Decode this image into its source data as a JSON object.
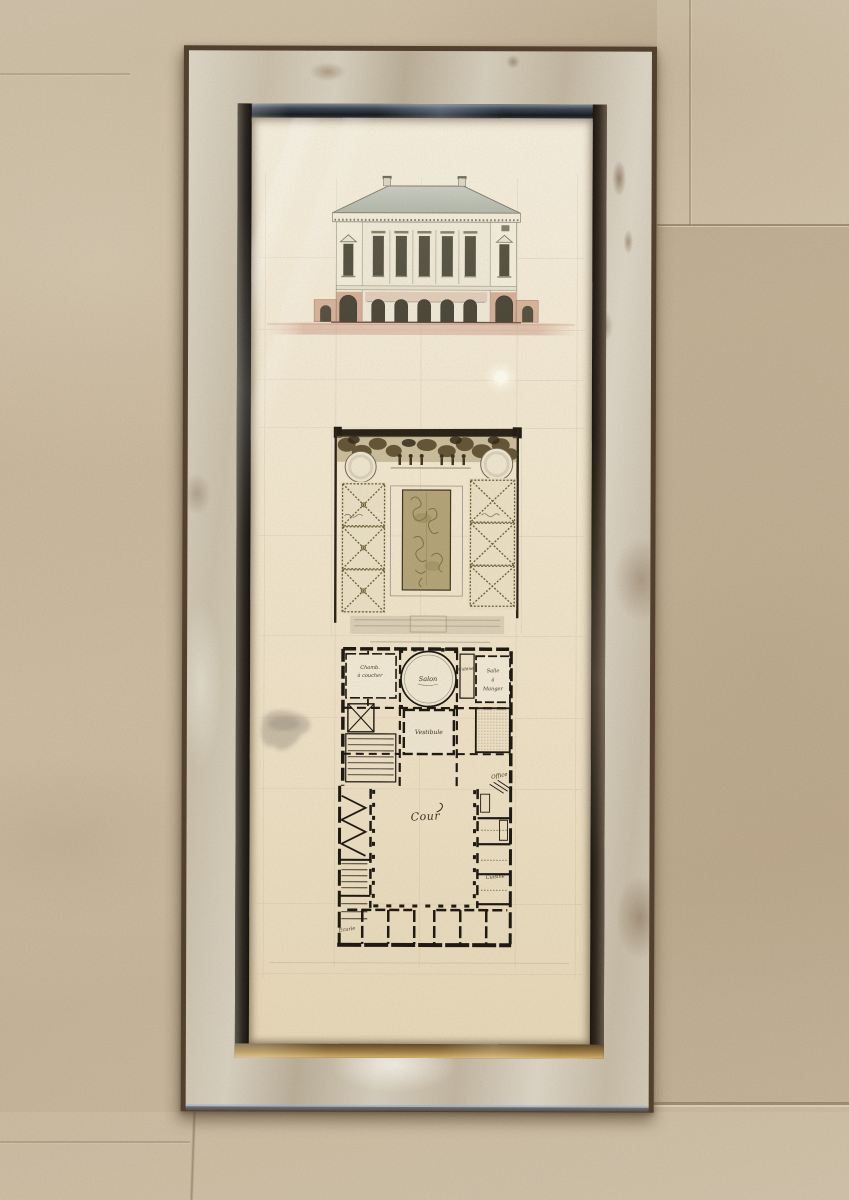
{
  "artwork": {
    "plan_labels": {
      "salon": "Salon",
      "vestibule": "Vestibule",
      "chambre_line1": "Chamb.",
      "chambre_line2": "à coucher",
      "cabinet": "Cabinet",
      "salle_line1": "Salle",
      "salle_line2": "à",
      "salle_line3": "Manger",
      "office": "Office",
      "cuisine": "Cuisine",
      "cour": "Cour",
      "ecurie": "Ecurie"
    }
  },
  "colors": {
    "wall": "#c8b79d",
    "frame_silver": "#d2c9b6",
    "frame_bronze": "#4e3b28",
    "molding_steel": "#222a34",
    "molding_gold": "#b8934e",
    "paper_cream": "#f1e7d0",
    "ink_sepia": "#2a2114",
    "roof_gray": "#b7bdb0",
    "terracotta": "#c58e72",
    "garden_olive": "#6b5a30",
    "parterre_tan": "#b2a375"
  }
}
